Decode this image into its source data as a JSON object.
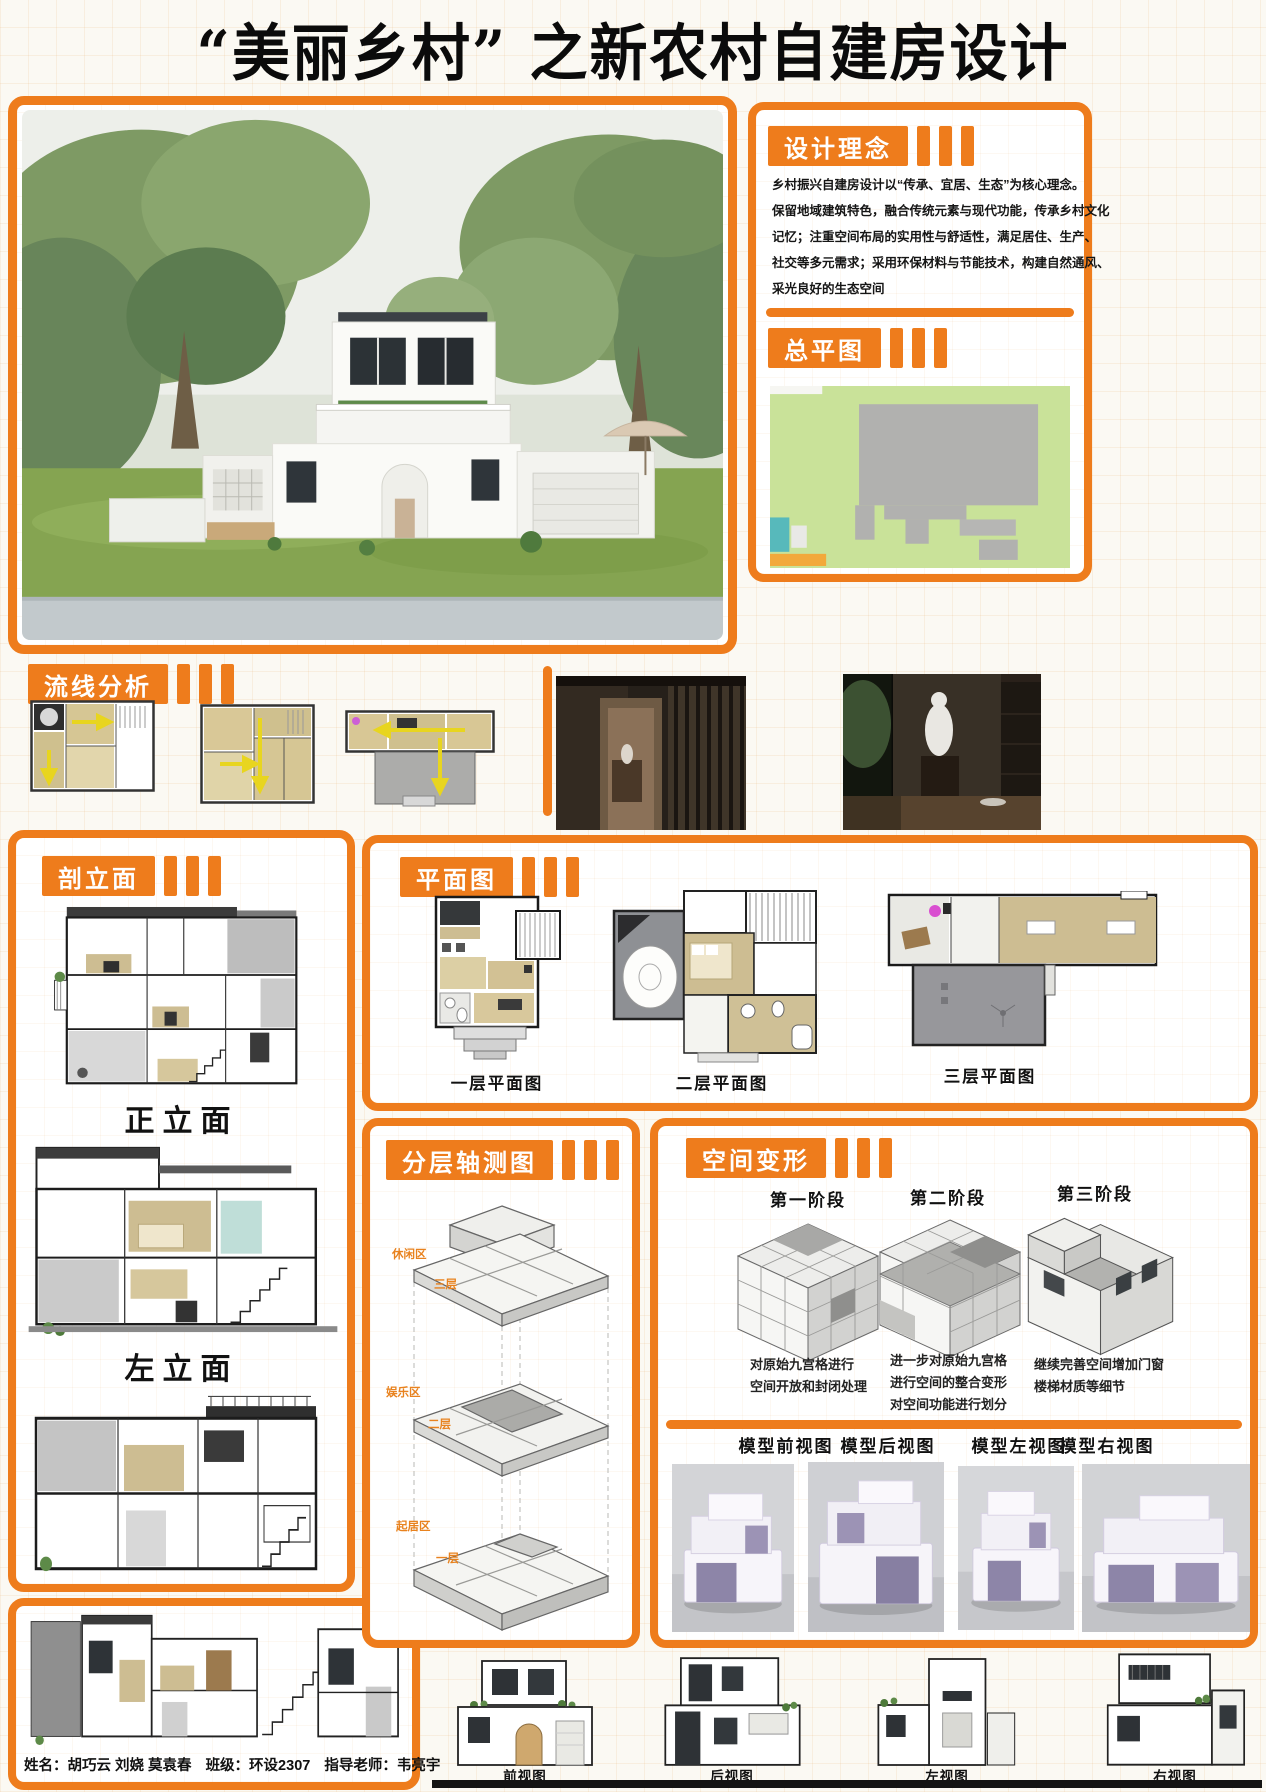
{
  "title": "“美丽乡村” 之新农村自建房设计",
  "design_concept": {
    "header": "设计理念",
    "lines": [
      "乡村振兴自建房设计以“传承、宜居、生态”为核心理念。",
      "保留地域建筑特色，融合传统元素与现代功能，传承乡村文化",
      "记忆；注重空间布局的实用性与舒适性，满足居住、生产、",
      "社交等多元需求；采用环保材料与节能技术，构建自然通风、",
      "采光良好的生态空间"
    ]
  },
  "site_plan": {
    "header": "总平图"
  },
  "circulation": {
    "header": "流线分析"
  },
  "sections_panel": {
    "header": "剖立面",
    "front_label": "正立面",
    "left_label": "左立面"
  },
  "floor_plans": {
    "header": "平面图",
    "labels": [
      "一层平面图",
      "二层平面图",
      "三层平面图"
    ]
  },
  "axonometric": {
    "header": "分层轴测图",
    "zones": [
      {
        "name": "休闲区",
        "floor": "三层"
      },
      {
        "name": "娱乐区",
        "floor": "二层"
      },
      {
        "name": "起居区",
        "floor": "一层"
      }
    ]
  },
  "transformation": {
    "header": "空间变形",
    "stages": [
      {
        "label": "第一阶段",
        "desc": [
          "对原始九宫格进行",
          "空间开放和封闭处理"
        ]
      },
      {
        "label": "第二阶段",
        "desc": [
          "进一步对原始九宫格",
          "进行空间的整合变形",
          "对空间功能进行划分"
        ]
      },
      {
        "label": "第三阶段",
        "desc": [
          "继续完善空间增加门窗",
          "楼梯材质等细节"
        ]
      }
    ],
    "model_views": [
      "模型前视图",
      "模型后视图",
      "模型左视图",
      "模型右视图"
    ]
  },
  "elevations": [
    "前视图",
    "后视图",
    "左视图",
    "右视图"
  ],
  "credits": {
    "name": "姓名：胡巧云 刘娆 莫袁春",
    "class": "班级：环设2307",
    "teacher": "指导老师：韦亮宇"
  },
  "colors": {
    "accent": "#EE7C1C",
    "site_green": "#C9E299",
    "plan_tan": "#CDBD92",
    "arrow_yellow": "#E8D51F"
  }
}
